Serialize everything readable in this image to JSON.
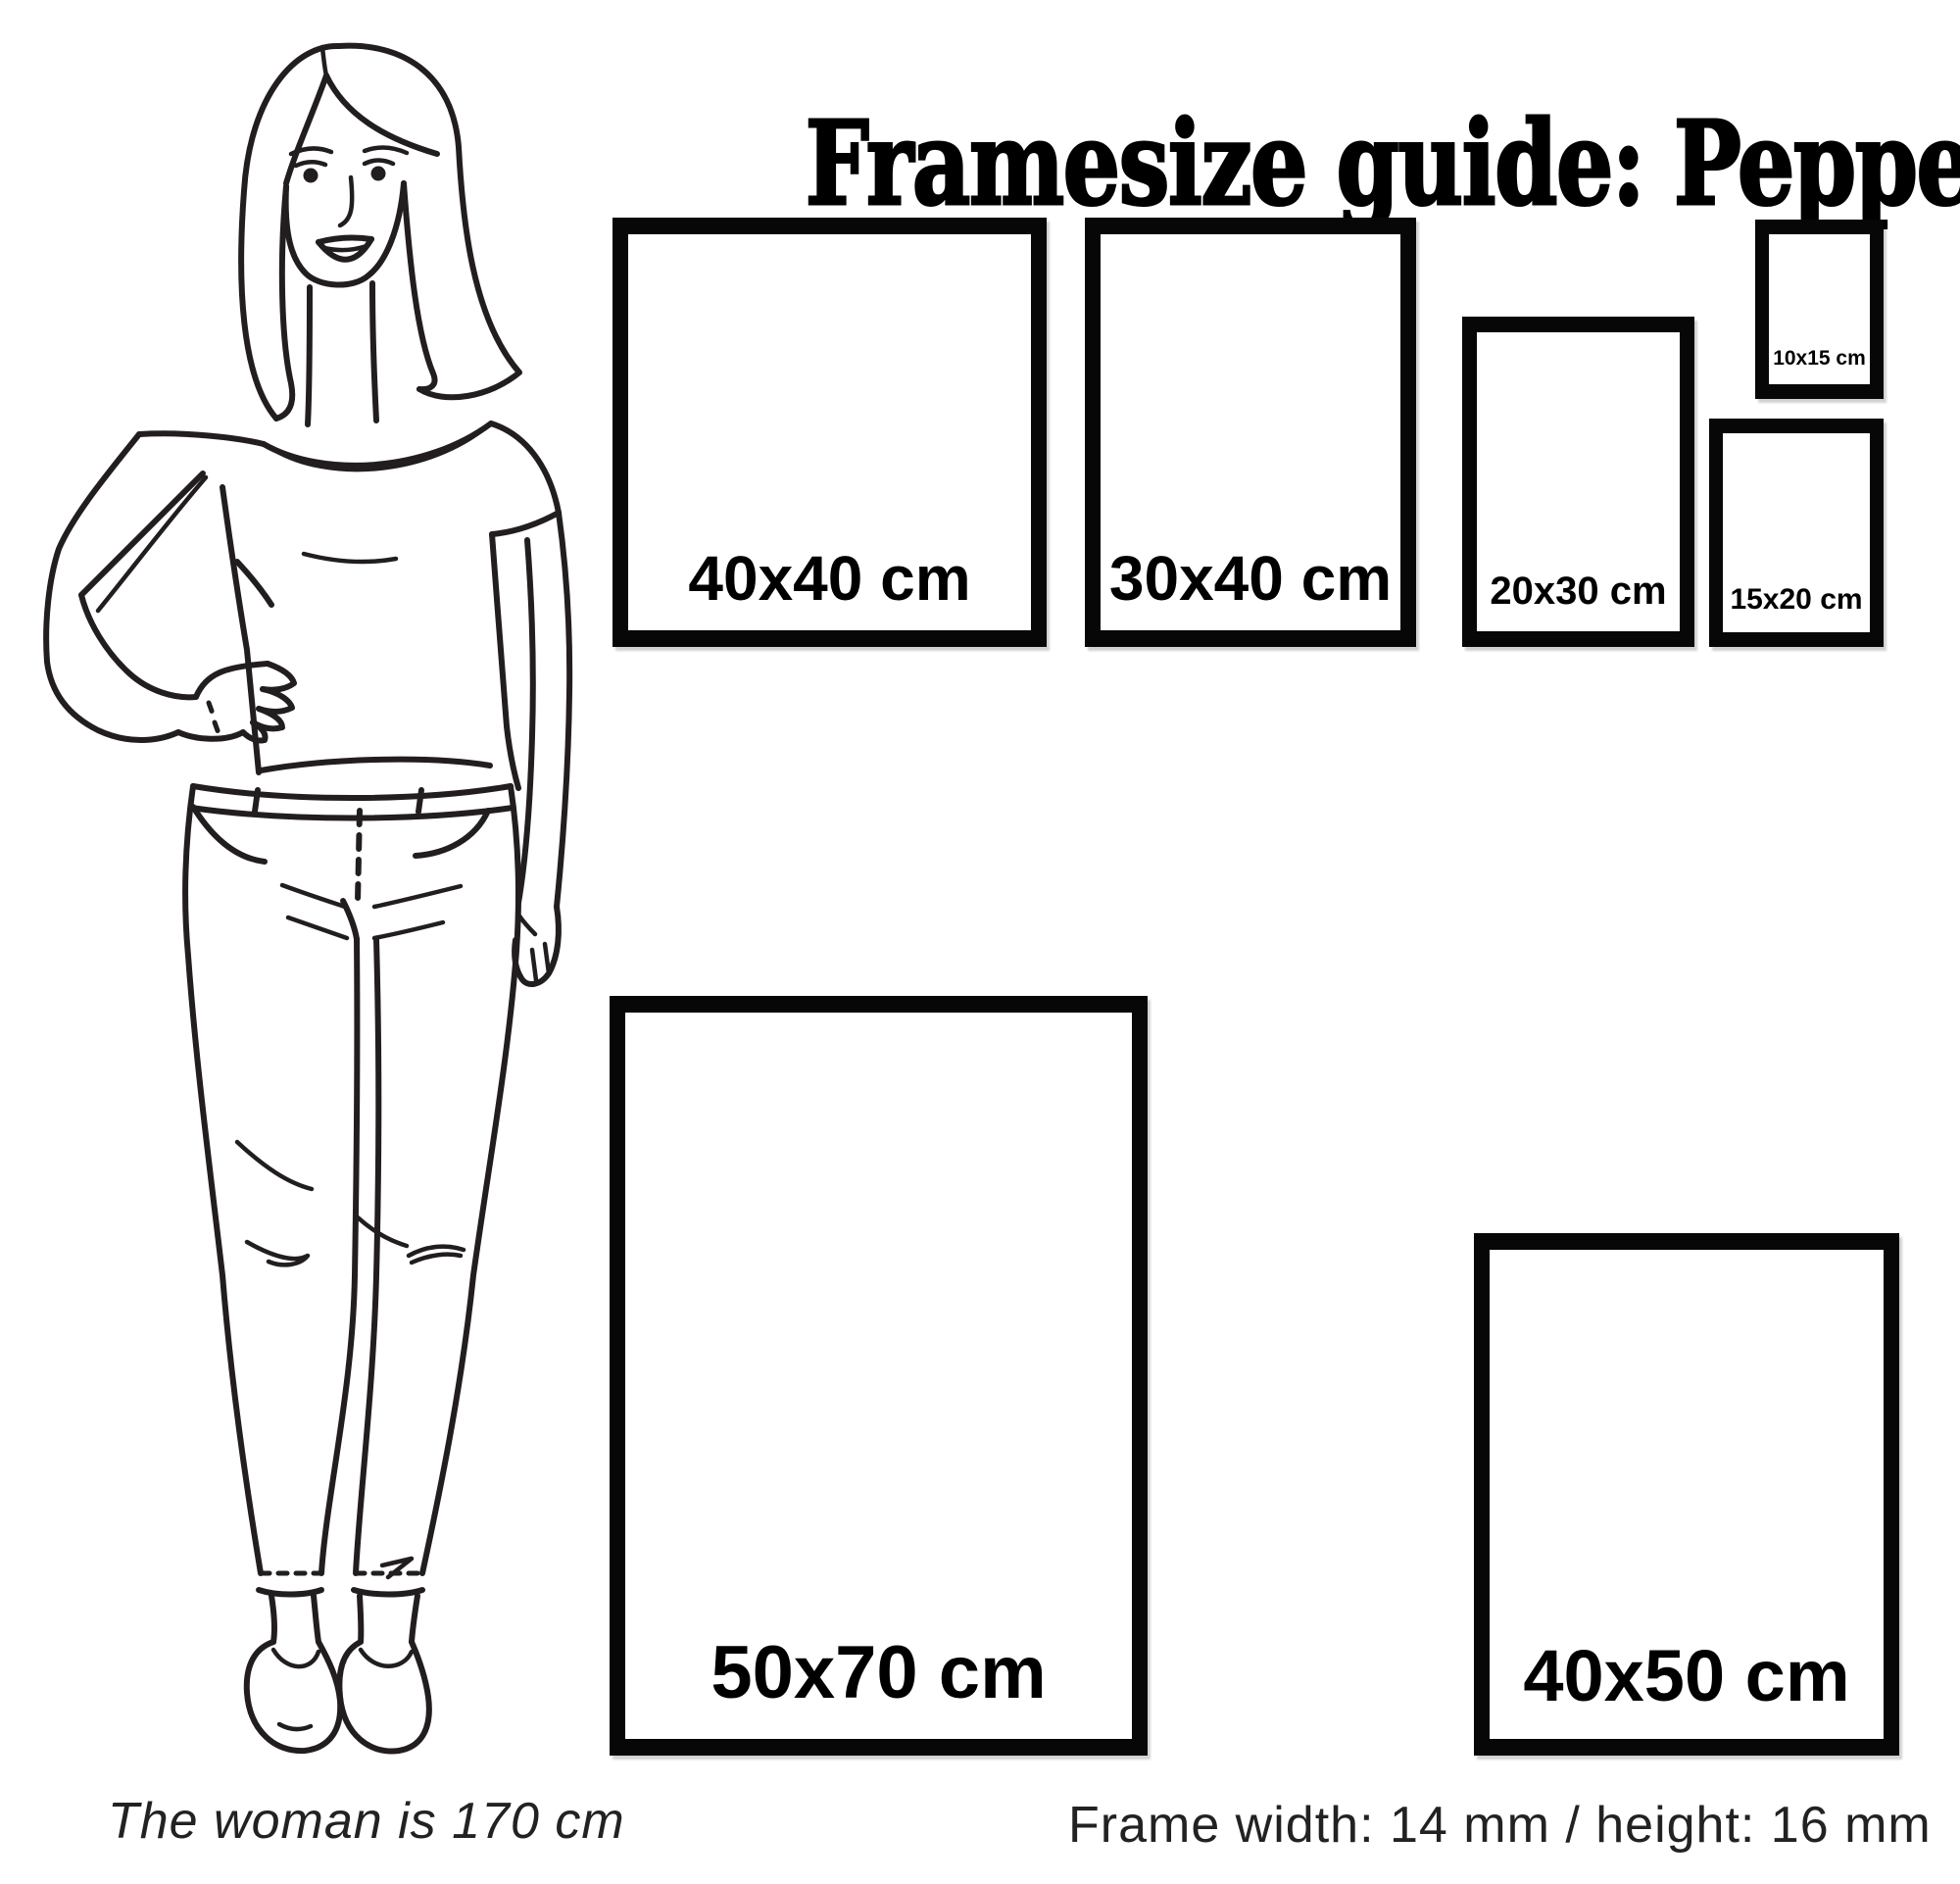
{
  "title": "Framesize guide: Peppers",
  "frames": [
    {
      "size": "40x40",
      "label": "40x40 cm"
    },
    {
      "size": "30x40",
      "label": "30x40 cm"
    },
    {
      "size": "20x30",
      "label": "20x30 cm"
    },
    {
      "size": "10x15",
      "label": "10x15 cm"
    },
    {
      "size": "15x20",
      "label": "15x20 cm"
    },
    {
      "size": "50x70",
      "label": "50x70 cm"
    },
    {
      "size": "40x50",
      "label": "40x50 cm"
    }
  ],
  "notes": {
    "woman_height": "The woman is 170 cm",
    "frame_spec": "Frame width: 14 mm / height: 16 mm"
  },
  "colors": {
    "background": "#ffffff",
    "frame_border": "#070707",
    "text": "#000000",
    "illustration_stroke": "#221e20"
  }
}
